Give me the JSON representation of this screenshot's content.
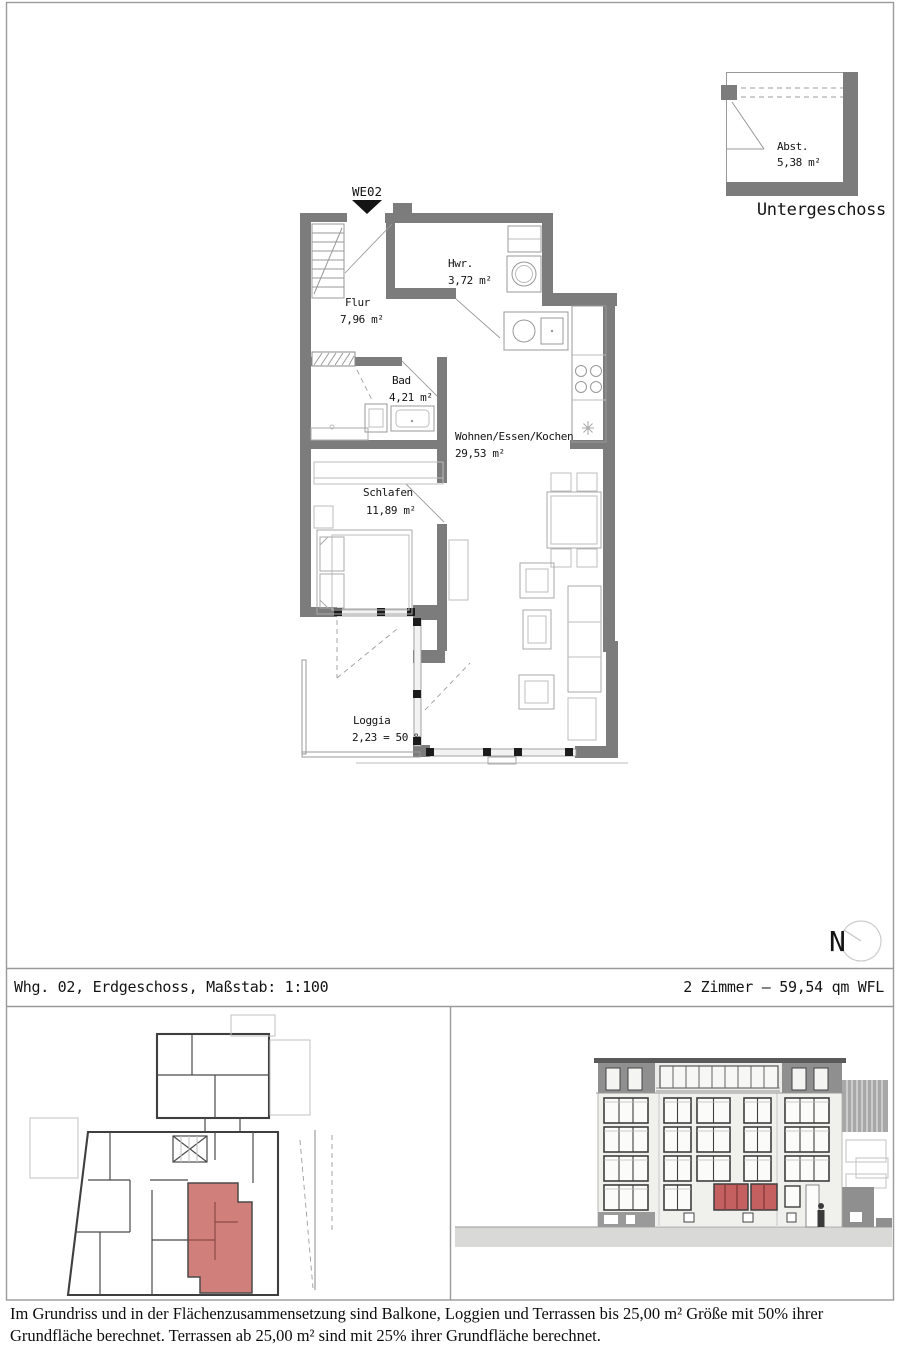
{
  "basement_plan": {
    "room": "Abst.",
    "area": "5,38 m²",
    "caption": "Untergeschoss"
  },
  "floor_plan": {
    "unit": "WE02",
    "rooms": {
      "flur": {
        "name": "Flur",
        "area": "7,96 m²"
      },
      "hwr": {
        "name": "Hwr.",
        "area": "3,72 m²"
      },
      "bad": {
        "name": "Bad",
        "area": "4,21 m²"
      },
      "wohnen": {
        "name": "Wohnen/Essen/Kochen",
        "area": "29,53 m²"
      },
      "schlafen": {
        "name": "Schlafen",
        "area": "11,89 m²"
      },
      "loggia": {
        "name": "Loggia",
        "area": "2,23 = 50 %"
      }
    }
  },
  "compass": {
    "label": "N"
  },
  "title_bar": {
    "left": "Whg. 02, Erdgeschoss, Maßstab: 1:100",
    "right": "2 Zimmer – 59,54 qm WFL"
  },
  "footnote": {
    "line1": "Im Grundriss und in der Flächenzusammensetzung  sind Balkone, Loggien und Terrassen bis 25,00 m² Größe mit 50% ihrer",
    "line2": "Grundfläche berechnet. Terrassen ab 25,00 m² sind mit 25% ihrer Grundfläche berechnet."
  },
  "colors": {
    "highlight": "#c4605f",
    "wall": "#7c7c7c"
  }
}
